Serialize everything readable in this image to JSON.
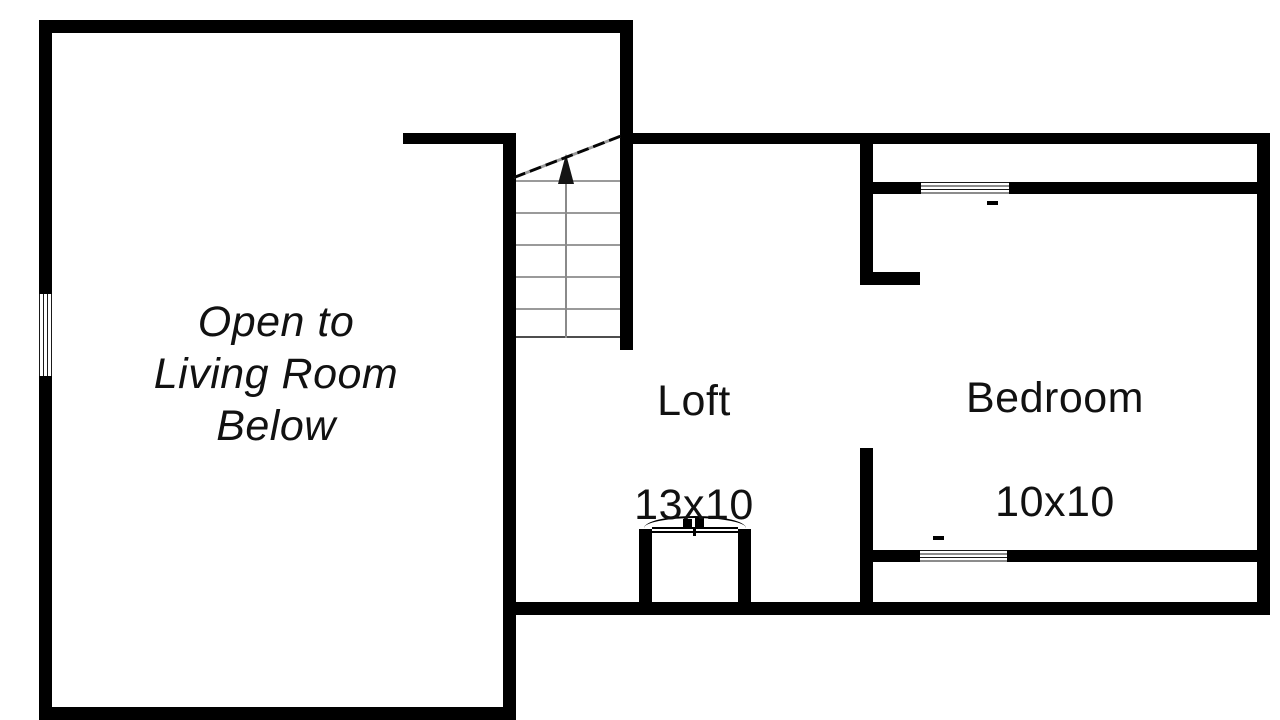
{
  "colors": {
    "background": "#ffffff",
    "wall": "#000000",
    "stair_tread": "#9a9a9a",
    "text": "#111111"
  },
  "rooms": {
    "open_area": {
      "label": "Open to\nLiving Room\nBelow"
    },
    "loft": {
      "name": "Loft",
      "dims": "13x10"
    },
    "bedroom": {
      "name": "Bedroom",
      "dims": "10x10"
    }
  },
  "symbols": {
    "stairs_arrow": "up-arrow",
    "stairs_break": "diagonal-dashed-line",
    "left_window": "window",
    "bedroom_top_window": "window",
    "bedroom_bottom_window": "window",
    "chimney": "chimney"
  }
}
